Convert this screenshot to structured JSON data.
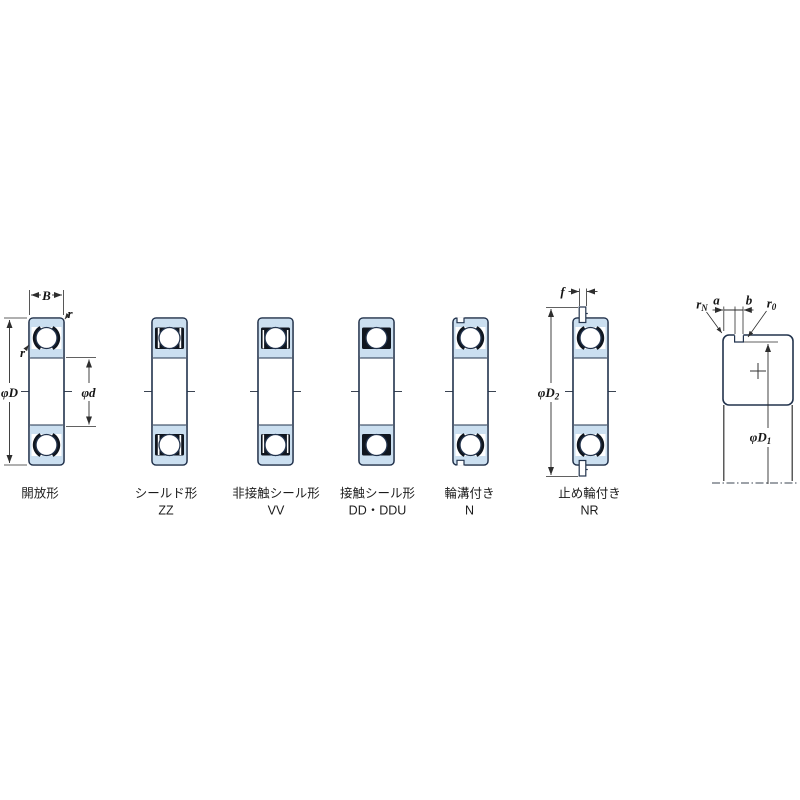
{
  "bearing_types": [
    {
      "label": "開放形",
      "code": ""
    },
    {
      "label": "シールド形",
      "code": "ZZ"
    },
    {
      "label": "非接触シール形",
      "code": "VV"
    },
    {
      "label": "接触シール形",
      "code": "DD・DDU"
    },
    {
      "label": "輪溝付き",
      "code": "N"
    },
    {
      "label": "止め輪付き",
      "code": "NR"
    }
  ],
  "dimension_labels": {
    "width": "B",
    "outer_chamfer": "r",
    "inner_chamfer": "r",
    "outer_diameter": "φD",
    "bore_diameter": "φd",
    "snap_ring_width": "f",
    "snap_ring_od_main": "φD",
    "snap_ring_od_sub": "2",
    "groove_dia_main": "φD",
    "groove_dia_sub": "1",
    "groove_position": "a",
    "groove_width": "b",
    "groove_fillet_n_main": "r",
    "groove_fillet_n_sub": "N",
    "groove_fillet_0_main": "r",
    "groove_fillet_0_sub": "0"
  },
  "colors": {
    "ring_fill": "#cbdff0",
    "outline": "#22334d",
    "detail_dark": "#10161f",
    "dimension": "#2e2e2e",
    "background": "#ffffff"
  }
}
